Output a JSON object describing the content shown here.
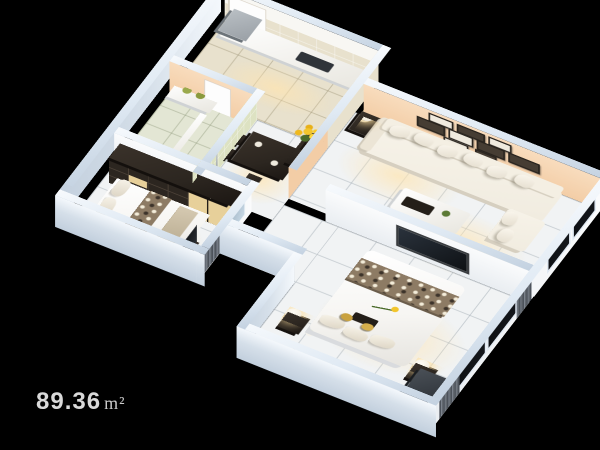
{
  "area_label": {
    "value": "89.36",
    "unit": "m²",
    "full": "89.36 m²"
  },
  "scene": {
    "type": "isometric-3d-floor-plan-render",
    "background": "black",
    "rooms": [
      {
        "id": "living-room",
        "name": "living room",
        "features": [
          "white L-shaped sofa with cushions",
          "gallery of 9 dark picture frames on peach wall",
          "white coffee table with dark tray and plant",
          "dark side table with lamp",
          "dark media console",
          "balcony niche with dark glass panes"
        ]
      },
      {
        "id": "kitchen",
        "name": "kitchen",
        "features": [
          "white counter",
          "gray refrigerator",
          "beige tile walls"
        ]
      },
      {
        "id": "hall-dining",
        "name": "hall / dining",
        "features": [
          "dark dining table with chairs",
          "black sideboard with sunflower vase",
          "white door"
        ]
      },
      {
        "id": "bathroom",
        "name": "bathroom",
        "features": [
          "pale green tile walls",
          "chrome shower",
          "white vanity with green plants"
        ]
      },
      {
        "id": "bedroom-small",
        "name": "small bedroom",
        "features": [
          "dark wardrobe with cream doors",
          "white bed with patterned runner",
          "TV at foot of bed",
          "gray vertical blinds and glass door"
        ]
      },
      {
        "id": "bedroom-master",
        "name": "master bedroom",
        "features": [
          "white double bed with patterned runner and flower",
          "two dark nightstands with white drum lamps",
          "wall TV",
          "dark windows with gray curtains",
          "dark corner cabinet"
        ]
      }
    ]
  },
  "palette": {
    "background": "#000000",
    "label_text": "#d9d9d9",
    "wall_cap": "#dfe9f3",
    "wall_exterior": "#d5dfe9",
    "peach_wall": "#f3cda6",
    "green_tile": "#dde2c2",
    "beige_tile": "#e8e1cd",
    "floor_tile": "#f1f3f4",
    "espresso": "#2c2620",
    "cream_door": "#e7d09a",
    "sofa_white": "#f1ece0",
    "bed_white": "#f7f6f3",
    "runner_brown": "#8d7b64",
    "curtain_gray": "#62686f",
    "window_glass": "#0b0d10",
    "sunflower_yellow": "#f2c52c",
    "leaf_green": "#4a6b2a",
    "lamp_glow": "#ffe4af",
    "fridge_gray": "#9aa0a6"
  }
}
